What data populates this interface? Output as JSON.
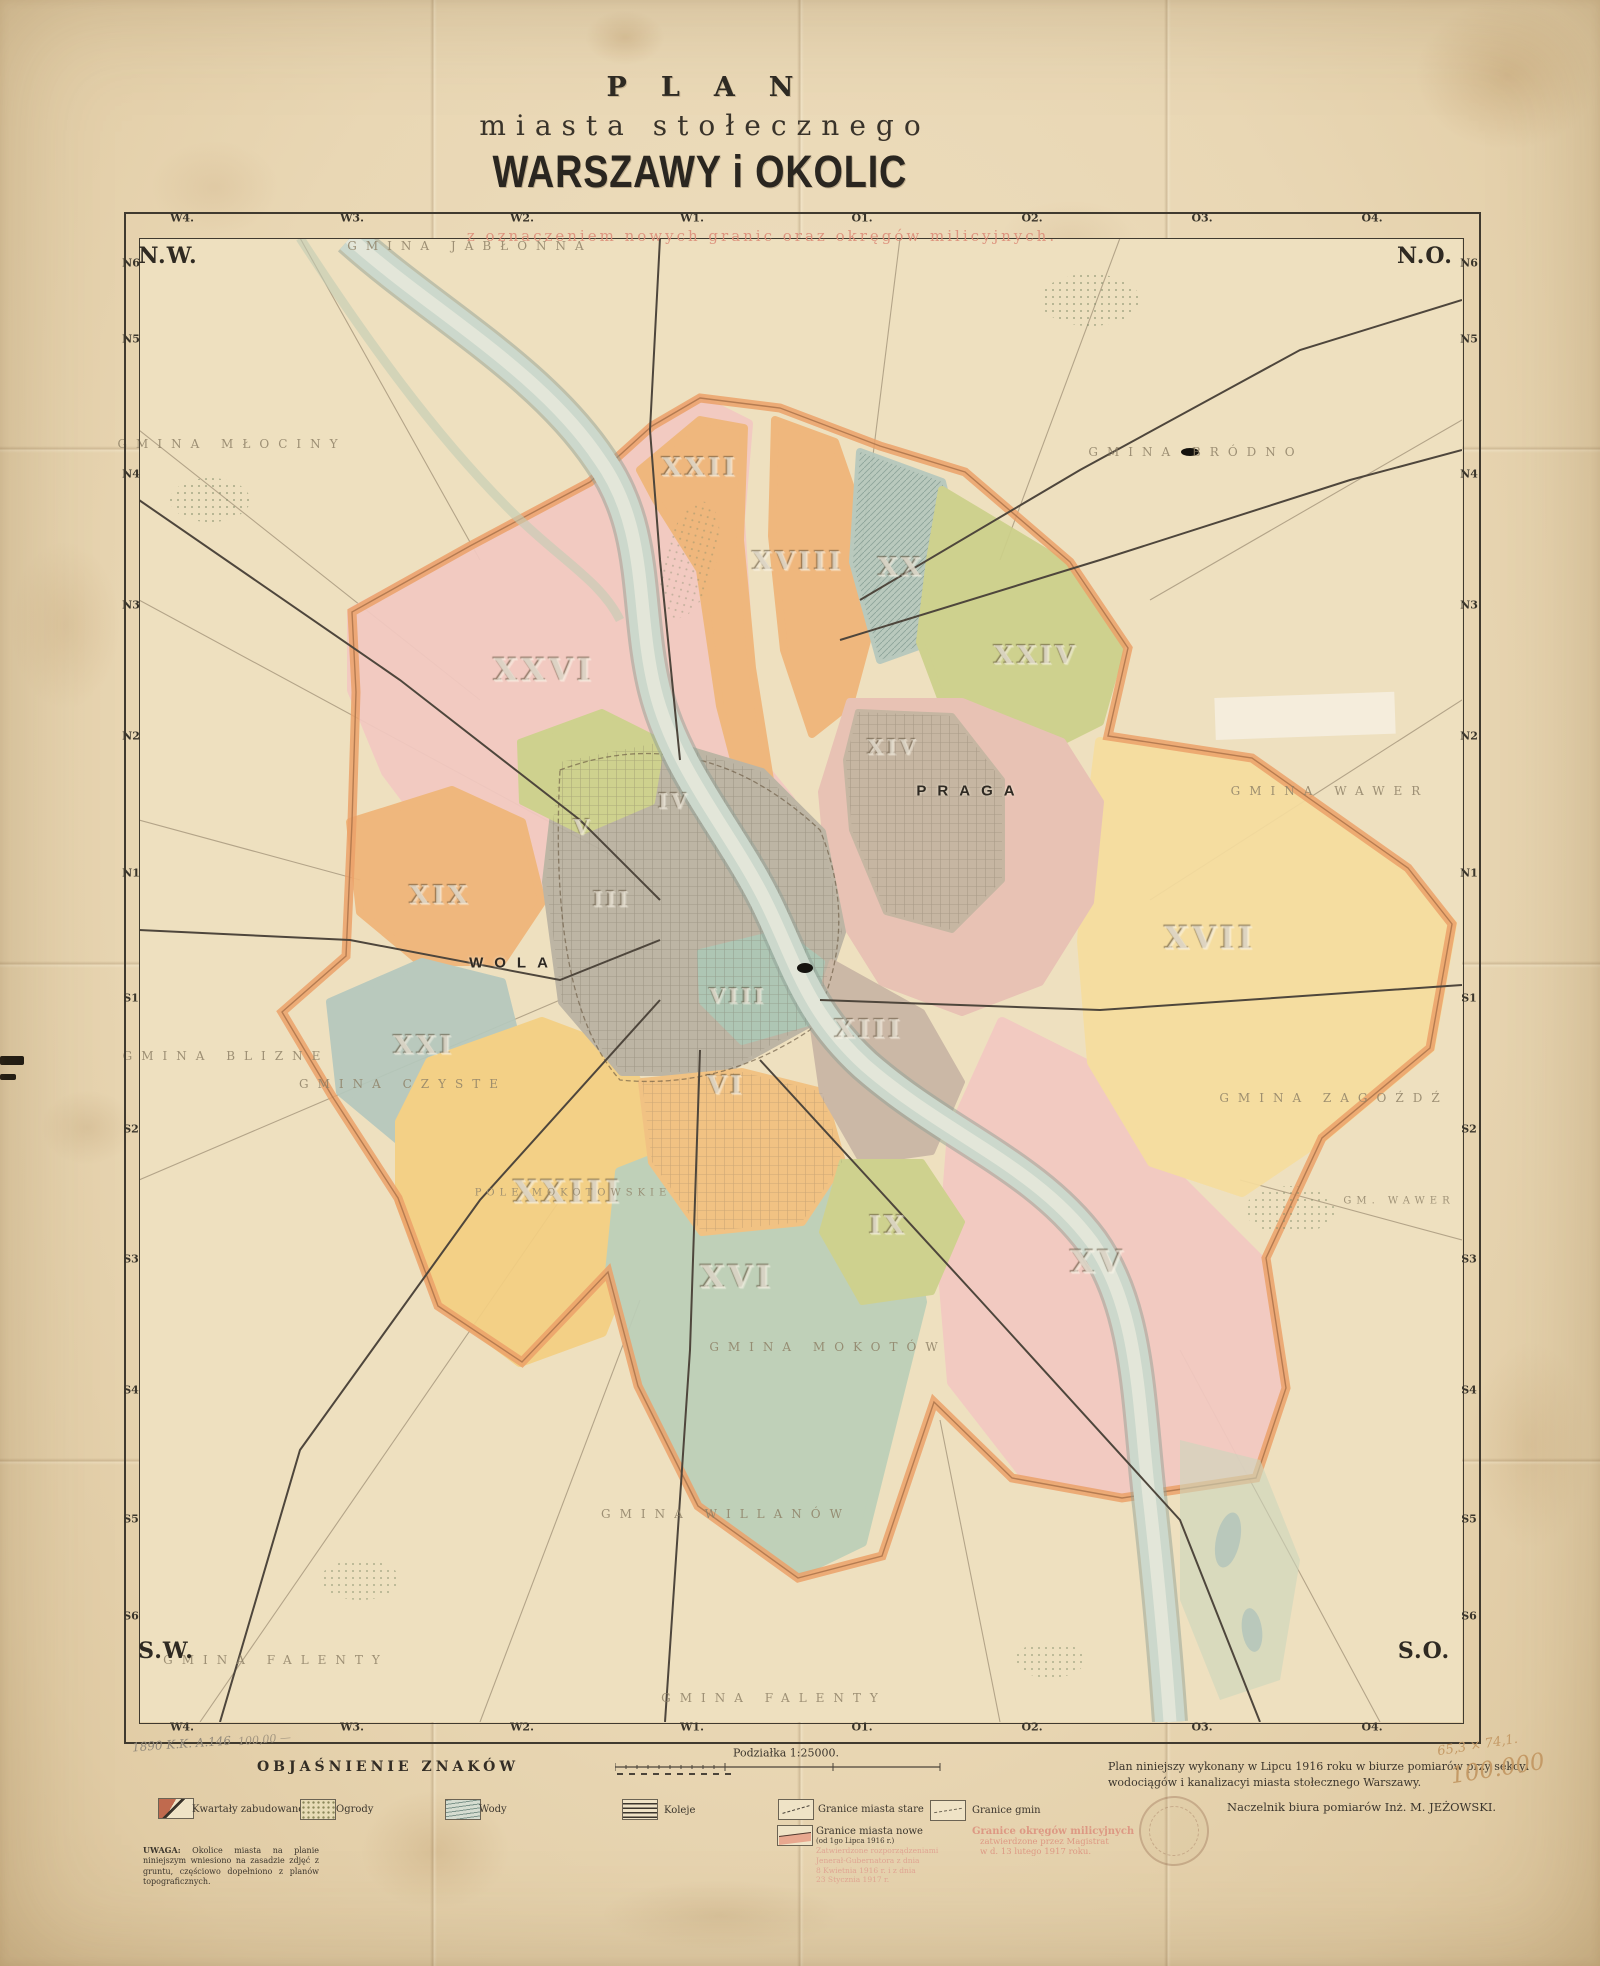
{
  "header": {
    "line1": "PLAN",
    "line2": "miasta stołecznego",
    "line3": "WARSZAWY i OKOLIC",
    "subtitle": "z oznaczeniem nowych granic oraz okręgów milicyjnych."
  },
  "compass": {
    "nw": "N.W.",
    "ne": "N.O.",
    "sw": "S.W.",
    "se": "S.O."
  },
  "grid": {
    "columns": [
      "W4.",
      "W3.",
      "W2.",
      "W1.",
      "O1.",
      "O2.",
      "O3.",
      "O4."
    ],
    "col_xs": [
      182,
      352,
      522,
      692,
      862,
      1032,
      1202,
      1372
    ],
    "rows": [
      "N6",
      "N5",
      "N4",
      "N3",
      "N2",
      "N1",
      "S1",
      "S2",
      "S3",
      "S4",
      "S5",
      "S6"
    ],
    "row_ys": [
      263,
      339,
      474,
      605,
      736,
      873,
      998,
      1129,
      1259,
      1390,
      1519,
      1616
    ]
  },
  "map": {
    "labels": [
      {
        "t": "XXVI",
        "k": "dxl",
        "x": 544,
        "y": 670
      },
      {
        "t": "XXII",
        "k": "dlg",
        "x": 700,
        "y": 468
      },
      {
        "t": "XVIII",
        "k": "dlg",
        "x": 798,
        "y": 562
      },
      {
        "t": "XX",
        "k": "dlg",
        "x": 901,
        "y": 568
      },
      {
        "t": "XXIV",
        "k": "dlg",
        "x": 1036,
        "y": 656
      },
      {
        "t": "XIV",
        "k": "dmd",
        "x": 893,
        "y": 747
      },
      {
        "t": "XVII",
        "k": "dxl",
        "x": 1210,
        "y": 938
      },
      {
        "t": "XIX",
        "k": "dlg",
        "x": 440,
        "y": 896
      },
      {
        "t": "XXI",
        "k": "dlg",
        "x": 424,
        "y": 1046
      },
      {
        "t": "V",
        "k": "dmd",
        "x": 583,
        "y": 827
      },
      {
        "t": "III",
        "k": "dmd",
        "x": 612,
        "y": 899
      },
      {
        "t": "IV",
        "k": "dmd",
        "x": 674,
        "y": 801
      },
      {
        "t": "VIII",
        "k": "dmd",
        "x": 738,
        "y": 996
      },
      {
        "t": "VI",
        "k": "dlg",
        "x": 726,
        "y": 1086
      },
      {
        "t": "XIII",
        "k": "dlg",
        "x": 869,
        "y": 1030
      },
      {
        "t": "IX",
        "k": "dlg",
        "x": 888,
        "y": 1226
      },
      {
        "t": "XXIII",
        "k": "dxl",
        "x": 568,
        "y": 1192
      },
      {
        "t": "XVI",
        "k": "dxl",
        "x": 737,
        "y": 1277
      },
      {
        "t": "XV",
        "k": "dxl",
        "x": 1098,
        "y": 1262
      },
      {
        "t": "WOLA",
        "k": "place",
        "x": 514,
        "y": 963
      },
      {
        "t": "PRAGA",
        "k": "place",
        "x": 971,
        "y": 791
      },
      {
        "t": "GMINA JABŁONNA",
        "k": "gmina",
        "x": 470,
        "y": 246
      },
      {
        "t": "GMINA MŁOCINY",
        "k": "gmina",
        "x": 232,
        "y": 444
      },
      {
        "t": "GMINA BRÓDNO",
        "k": "gmina",
        "x": 1196,
        "y": 452
      },
      {
        "t": "GMINA WAWER",
        "k": "gmina",
        "x": 1330,
        "y": 791
      },
      {
        "t": "GMINA ZAGOŹDŹ",
        "k": "gmina",
        "x": 1334,
        "y": 1098
      },
      {
        "t": "GM. WAWER",
        "k": "gminasm",
        "x": 1399,
        "y": 1201
      },
      {
        "t": "GMINA BLIZNE",
        "k": "gmina",
        "x": 226,
        "y": 1056
      },
      {
        "t": "GMINA CZYSTE",
        "k": "gmina",
        "x": 403,
        "y": 1084
      },
      {
        "t": "GMINA MOKOTÓW",
        "k": "gmina",
        "x": 828,
        "y": 1347
      },
      {
        "t": "GMINA WILLANÓW",
        "k": "gmina",
        "x": 726,
        "y": 1514
      },
      {
        "t": "GMINA FALENTY",
        "k": "gmina",
        "x": 276,
        "y": 1660
      },
      {
        "t": "GMINA FALENTY",
        "k": "gmina",
        "x": 774,
        "y": 1698
      },
      {
        "t": "POLE MOKOTOWSKIE",
        "k": "gminasm",
        "x": 573,
        "y": 1193
      }
    ]
  },
  "legend": {
    "heading": "OBJAŚNIENIE ZNAKÓW",
    "items": [
      {
        "label": "Kwartały zabudowane",
        "sym": "built",
        "bx": 158,
        "by": 1798,
        "lx": 192,
        "ly": 1804
      },
      {
        "label": "Ogrody",
        "sym": "garden",
        "bx": 300,
        "by": 1799,
        "lx": 336,
        "ly": 1804
      },
      {
        "label": "Wody",
        "sym": "water",
        "bx": 445,
        "by": 1799,
        "lx": 479,
        "ly": 1804
      },
      {
        "label": "Koleje",
        "sym": "rail",
        "bx": 622,
        "by": 1799,
        "lx": 664,
        "ly": 1805
      },
      {
        "label": "Granice miasta stare",
        "sym": "old",
        "bx": 778,
        "by": 1799,
        "lx": 818,
        "ly": 1804
      },
      {
        "label": "Granice gmin",
        "sym": "gmborder",
        "bx": 930,
        "by": 1800,
        "lx": 972,
        "ly": 1805
      },
      {
        "label": "Granice miasta nowe",
        "sub": "(od 1go Lipca 1916 r.)",
        "sym": "new",
        "bx": 777,
        "by": 1825,
        "lx": 816,
        "ly": 1826
      }
    ],
    "mil_item": {
      "line1": "Granice okręgów milicyjnych",
      "line2": "zatwierdzone przez Magistrat",
      "line3": "w d. 13 lutego 1917 roku."
    },
    "fineprint": [
      "Zatwierdzone rozporządzeniami",
      "Jenerał-Gubernatora z dnia",
      "8 Kwietnia 1916 r. i z dnia",
      "23 Stycznia 1917 r."
    ],
    "uwaga_label": "UWAGA:",
    "uwaga_text": " Okolice miasta na planie niniejszym wniesiono na zasadzie zdjęć z gruntu, częściowo dopełniono z planów topograficznych."
  },
  "scale": {
    "label": "Podziałka 1:25000."
  },
  "credits": {
    "line1": "Plan niniejszy wykonany w Lipcu 1916 roku w biurze pomiarów przy sekcyi",
    "line2": "wodociągów i kanalizacyi miasta stołecznego Warszawy.",
    "line3": "Naczelnik biura pomiarów  Inż. M. JEŻOWSKI."
  },
  "annotations": {
    "pencil_left": "1890 K.K. A.146",
    "pencil_left2": "100,00 —",
    "pencil_right_dims": "65,3 × 74,1.",
    "pencil_right_scale": "100.000"
  },
  "colors": {
    "paper": "#e9d7b4",
    "pink_note": "#dd9984",
    "district_pink": "#f3c9c2",
    "district_orange": "#f0b478",
    "district_yellow": "#f6dd9e",
    "district_olive": "#ccd08a",
    "district_teal": "#b5c8bd",
    "district_gray": "#b9b2a2",
    "river": "#ccd8cc",
    "boundary": "#eba168"
  }
}
